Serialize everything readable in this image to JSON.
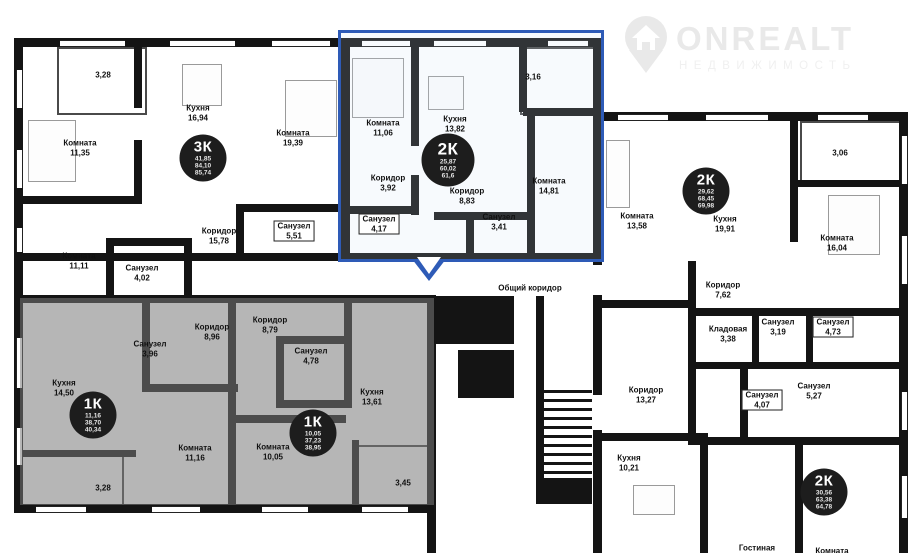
{
  "logo": {
    "brand": "ONREALT",
    "tagline": "НЕДВИЖИМОСТЬ"
  },
  "common": {
    "shared_corridor": "Общий коридор",
    "corridor13": {
      "name": "Коридор",
      "area": "13,27"
    }
  },
  "apartments": {
    "a3k": {
      "badge": {
        "type": "3К",
        "v1": "41,85",
        "v2": "84,10",
        "v3": "85,74"
      },
      "rooms": {
        "balcony": {
          "area": "3,28"
        },
        "room1": {
          "name": "Комната",
          "area": "11,35"
        },
        "kitchen": {
          "name": "Кухня",
          "area": "16,94"
        },
        "room2": {
          "name": "Комната",
          "area": "19,39"
        },
        "room3": {
          "name": "Комната",
          "area": "11,11"
        },
        "corridor": {
          "name": "Коридор",
          "area": "15,78"
        },
        "bath1": {
          "name": "Санузел",
          "area": "5,51"
        },
        "bath2": {
          "name": "Санузел",
          "area": "4,02"
        }
      }
    },
    "sel2k": {
      "badge": {
        "type": "2К",
        "v1": "25,87",
        "v2": "60,02",
        "v3": "61,6"
      },
      "rooms": {
        "room1": {
          "name": "Комната",
          "area": "11,06"
        },
        "kitchen": {
          "name": "Кухня",
          "area": "13,82"
        },
        "balcony": {
          "area": "3,16"
        },
        "corridor1": {
          "name": "Коридор",
          "area": "3,92"
        },
        "corridor2": {
          "name": "Коридор",
          "area": "8,83"
        },
        "room2": {
          "name": "Комната",
          "area": "14,81"
        },
        "bath1": {
          "name": "Санузел",
          "area": "4,17"
        },
        "bath2": {
          "name": "Санузел",
          "area": "3,41"
        }
      }
    },
    "r2k": {
      "badge": {
        "type": "2К",
        "v1": "29,62",
        "v2": "68,45",
        "v3": "69,98"
      },
      "rooms": {
        "room1": {
          "name": "Комната",
          "area": "13,58"
        },
        "kitchen": {
          "name": "Кухня",
          "area": "19,91"
        },
        "balcony": {
          "area": "3,06"
        },
        "room2": {
          "name": "Комната",
          "area": "16,04"
        },
        "corridor": {
          "name": "Коридор",
          "area": "7,62"
        },
        "storage": {
          "name": "Кладовая",
          "area": "3,38"
        },
        "bath1": {
          "name": "Санузел",
          "area": "3,19"
        },
        "bath2": {
          "name": "Санузел",
          "area": "4,73"
        }
      }
    },
    "l1k": {
      "badge": {
        "type": "1К",
        "v1": "11,16",
        "v2": "38,70",
        "v3": "40,34"
      },
      "rooms": {
        "corridor": {
          "name": "Коридор",
          "area": "8,96"
        },
        "bath": {
          "name": "Санузел",
          "area": "3,96"
        },
        "kitchen": {
          "name": "Кухня",
          "area": "14,50"
        },
        "room1": {
          "name": "Комната",
          "area": "11,16"
        },
        "balcony": {
          "area": "3,28"
        }
      }
    },
    "m1k": {
      "badge": {
        "type": "1К",
        "v1": "10,05",
        "v2": "37,23",
        "v3": "38,95"
      },
      "rooms": {
        "corridor": {
          "name": "Коридор",
          "area": "8,79"
        },
        "bath": {
          "name": "Санузел",
          "area": "4,78"
        },
        "kitchen": {
          "name": "Кухня",
          "area": "13,61"
        },
        "room1": {
          "name": "Комната",
          "area": "10,05"
        },
        "balcony": {
          "area": "3,45"
        }
      }
    },
    "b2k": {
      "badge": {
        "type": "2К",
        "v1": "30,56",
        "v2": "63,38",
        "v3": "64,78"
      },
      "rooms": {
        "bath1": {
          "name": "Санузел",
          "area": "4,07"
        },
        "bath2": {
          "name": "Санузел",
          "area": "5,27"
        },
        "kitchen": {
          "name": "Кухня",
          "area": "10,21"
        },
        "living": {
          "name": "Гостиная"
        },
        "room": {
          "name": "Комната"
        }
      }
    }
  },
  "colors": {
    "highlight": "#2e5bb7",
    "badge_bg": "#1d1d1d",
    "sold_overlay": "#7a7a7a"
  }
}
